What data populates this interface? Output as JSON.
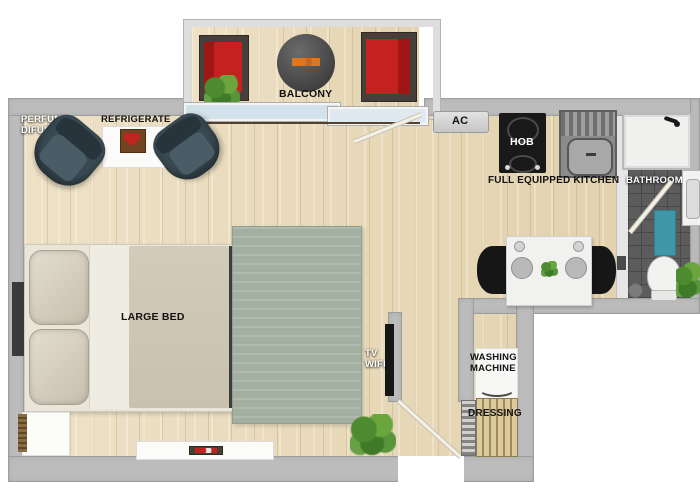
{
  "rooms": {
    "balcony": {
      "label": "BALCONY"
    },
    "living_area": {
      "perfume_difusser_label": "PERFUME\nDIFUSSER",
      "refrigerate_label": "REFRIGERATE",
      "bed_label": "LARGE BED",
      "tv_label": "TV\nWIFI"
    },
    "kitchen": {
      "ac_label": "AC",
      "hob_label": "HOB",
      "kitchen_label": "FULL EQUIPPED KITCHEN"
    },
    "bathroom": {
      "label": "BATHROOM"
    },
    "utility": {
      "washing_machine_label": "WASHING\nMACHINE",
      "dressing_label": "DRESSING"
    }
  },
  "colors": {
    "wall": "#bcbcbc",
    "wood_floor": "#e8dcbf",
    "tile_floor": "#5c5c5c",
    "sofa_red": "#c62120",
    "armchair_slate": "#3a4a53",
    "rug": "#a3afa1",
    "bath_mat_teal": "#3f97a8",
    "plant_green": "#4e8a2f",
    "hob_black": "#191919"
  }
}
